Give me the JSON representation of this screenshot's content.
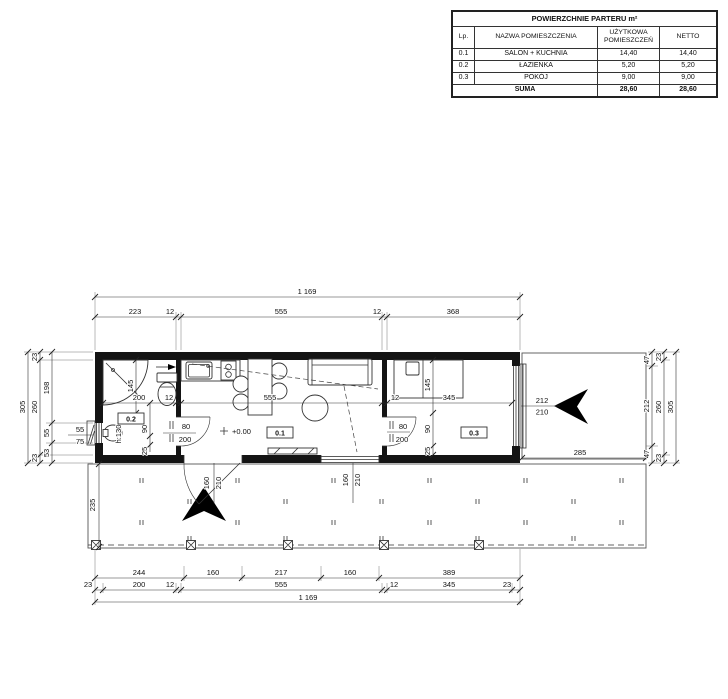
{
  "area_table": {
    "title": "POWIERZCHNIE PARTERU  m²",
    "columns": [
      "Lp.",
      "NAZWA POMIESZCZENIA",
      "UŻYTKOWA POMIESZCZEŃ",
      "NETTO"
    ],
    "rows": [
      {
        "lp": "0.1",
        "name": "SALON + KUCHNIA",
        "usable": "14,40",
        "netto": "14,40"
      },
      {
        "lp": "0.2",
        "name": "ŁAZIENKA",
        "usable": "5,20",
        "netto": "5,20"
      },
      {
        "lp": "0.3",
        "name": "POKÓJ",
        "usable": "9,00",
        "netto": "9,00"
      }
    ],
    "sum_row": {
      "label": "SUMA",
      "usable": "28,60",
      "netto": "28,60"
    }
  },
  "plan": {
    "rooms": {
      "living": "0.1",
      "bath": "0.2",
      "bedroom": "0.3"
    },
    "level": "+0.00",
    "dims": {
      "top_total": "1 169",
      "top": [
        "223",
        "12",
        "555",
        "12",
        "368"
      ],
      "bottom_openings": [
        "244",
        "160",
        "217",
        "160",
        "389"
      ],
      "bottom_axes": [
        "23",
        "200",
        "12",
        "555",
        "12",
        "345",
        "23"
      ],
      "bottom_total": "1 169",
      "left_outer": "305",
      "left_mid": [
        "23",
        "260",
        "23"
      ],
      "left_window_chain": [
        "198",
        "55",
        "53"
      ],
      "left_window": [
        "55",
        "75"
      ],
      "right_window_chain": [
        "47",
        "212",
        "47"
      ],
      "right_mid": [
        "23",
        "260",
        "23"
      ],
      "right_outer": "305",
      "interior": [
        "200",
        "12",
        "555",
        "12",
        "345"
      ],
      "bath_depth": "145",
      "bath_door_offset": [
        "90",
        "25"
      ],
      "basin": "h:130",
      "bath_door": [
        "80",
        "200"
      ],
      "bedroom_door": [
        "80",
        "200"
      ],
      "bed": "145",
      "bedroom_door_offset": [
        "90",
        "25"
      ],
      "entry_door": [
        "160",
        "210"
      ],
      "terrace_window": [
        "160",
        "210"
      ],
      "east_window": [
        "212",
        "210"
      ],
      "deck_width": "285",
      "deck_depth": "235"
    }
  }
}
